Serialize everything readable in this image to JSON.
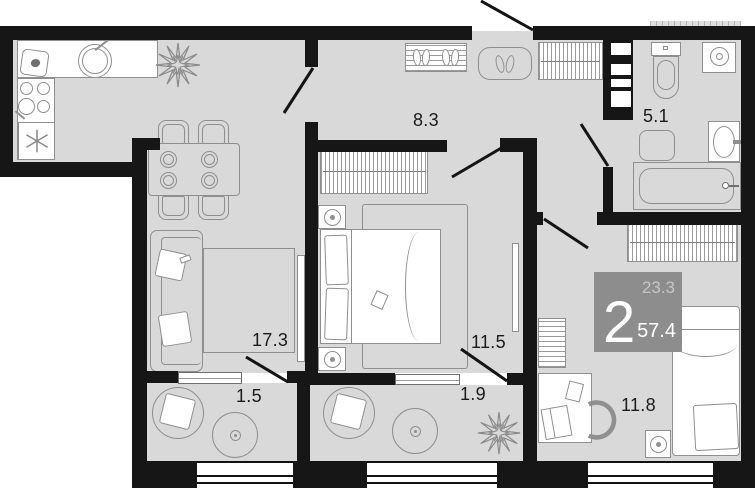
{
  "title": "2-room apartment floor plan",
  "rooms": [
    {
      "name": "hallway",
      "area": "8.3"
    },
    {
      "name": "bathroom",
      "area": "5.1"
    },
    {
      "name": "living-kitchen",
      "area": "17.3"
    },
    {
      "name": "bedroom",
      "area": "11.5"
    },
    {
      "name": "loggia-left",
      "area": "1.5"
    },
    {
      "name": "loggia-right",
      "area": "1.9"
    },
    {
      "name": "bedroom-2",
      "area": "11.8"
    }
  ],
  "badge": {
    "rooms_count": "2",
    "living_area": "23.3",
    "total_area": "57.4"
  },
  "colors": {
    "wall": "#161616",
    "floor": "#d9d9d9",
    "furniture_outline": "#8f8f8f",
    "badge_bg": "#8d8d8d",
    "badge_muted_text": "#c6c6c6",
    "badge_text": "#ffffff",
    "label_text": "#1b1b1b"
  }
}
